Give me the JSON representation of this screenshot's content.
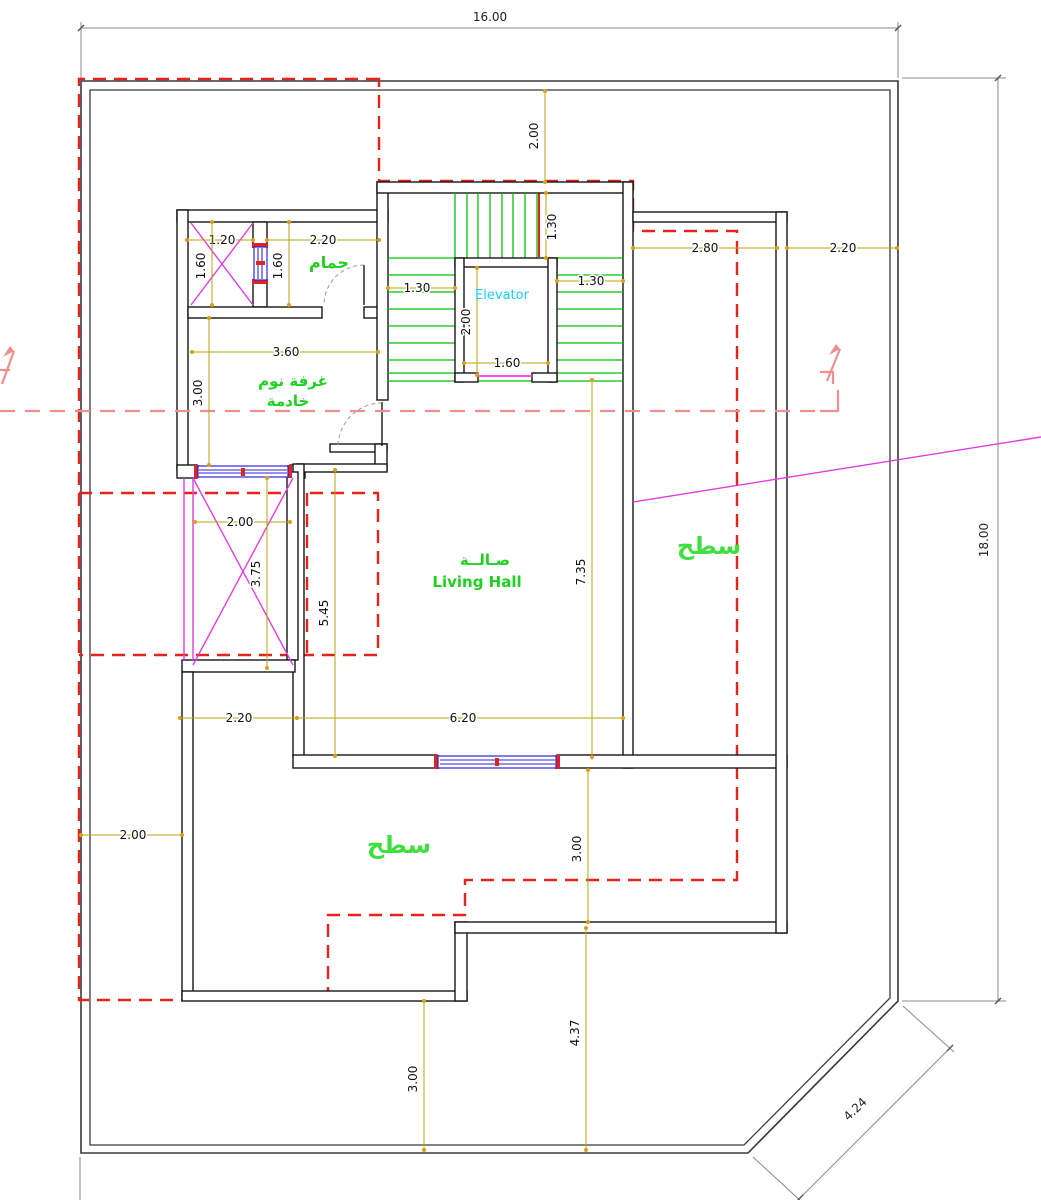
{
  "dims": {
    "plot_width": "16.00",
    "plot_depth": "18.00",
    "chamfer": "4.24",
    "top_setback": "2.00",
    "shaft_width": "1.20",
    "bath_width": "2.20",
    "shaft_height": "1.60",
    "bath_height": "1.60",
    "stair_flight_top": "1.30",
    "stair_flight_left": "1.30",
    "stair_flight_right": "1.30",
    "elevator_depth": "2.00",
    "elevator_width": "1.60",
    "right_offset_inner": "2.80",
    "right_offset_outer": "2.20",
    "maid_width": "3.60",
    "maid_height": "3.00",
    "court_width": "2.00",
    "court_height": "3.75",
    "hall_left_height": "5.45",
    "hall_right_height": "7.35",
    "left_setback": "2.00",
    "terrace_width": "2.20",
    "hall_width": "6.20",
    "terrace_depth": "3.00",
    "rear_setback": "3.00",
    "rear_right_setback": "4.37"
  },
  "labels": {
    "bathroom": "حمام",
    "maid_bedroom_line1": "غرفة نوم",
    "maid_bedroom_line2": "خادمة",
    "hall_arabic": "صـالــة",
    "hall_english": "Living Hall",
    "elevator": "Elevator",
    "roof_right": "سطح",
    "roof_bottom": "سطح"
  },
  "colors": {
    "wall": "#161616",
    "red_dashed": "#e5231b",
    "section_line": "#ef8e8e",
    "stair_green": "#00c300",
    "label_green": "#1fd11f",
    "magenta": "#e13ce1",
    "elevator_cyan": "#19cfe9",
    "dimension_olive": "#b5a40a",
    "window_blue": "#2727dd"
  }
}
